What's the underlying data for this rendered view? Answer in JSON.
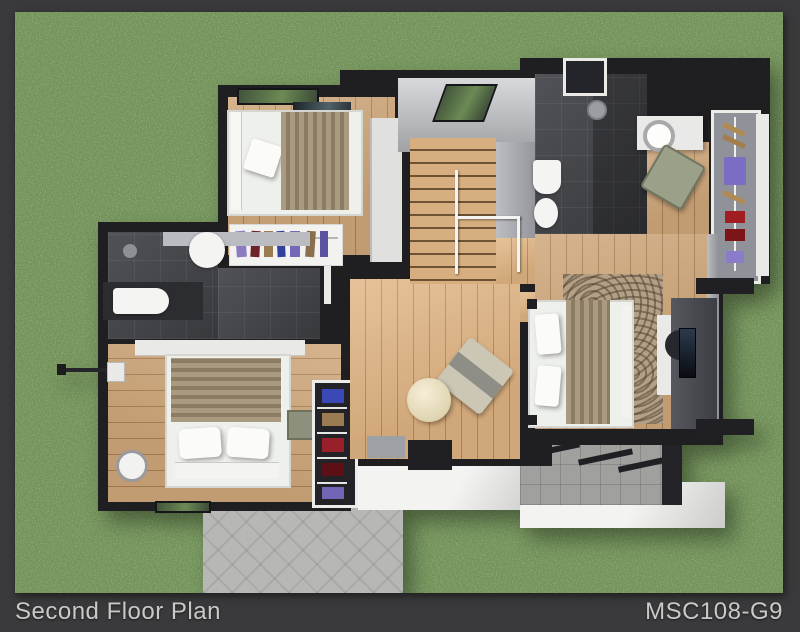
{
  "caption": {
    "title": "Second Floor Plan",
    "code": "MSC108-G9"
  },
  "frame": {
    "background": "#3a3a3c",
    "text_color": "#c9c9c9"
  },
  "grass": {
    "base_color": "#6d8f53"
  },
  "palette": {
    "wall": "#1f1f22",
    "wood_floor": "#c49a6c",
    "dark_bath_tile": "#434448",
    "terrace_tile": "#a0a09e",
    "patio_tile": "#b7b7b5",
    "roof_white": "#f0f0ee",
    "bed_linen": "#eef0ec",
    "blanket_tan": "#9c8a71",
    "rug_tan": "#b2a186",
    "chair_olive": "#9ba189",
    "table_cream": "#e9dfbe",
    "clothes_accents": [
      "#7b6cc4",
      "#a01d22",
      "#3a49b5",
      "#9a7b52"
    ]
  },
  "rooms": [
    "bedroom-1",
    "bathroom-1",
    "bedroom-2",
    "bathroom-2",
    "hallway-stairs",
    "dressing-area",
    "master-bedroom",
    "balcony-terrace",
    "patio"
  ]
}
